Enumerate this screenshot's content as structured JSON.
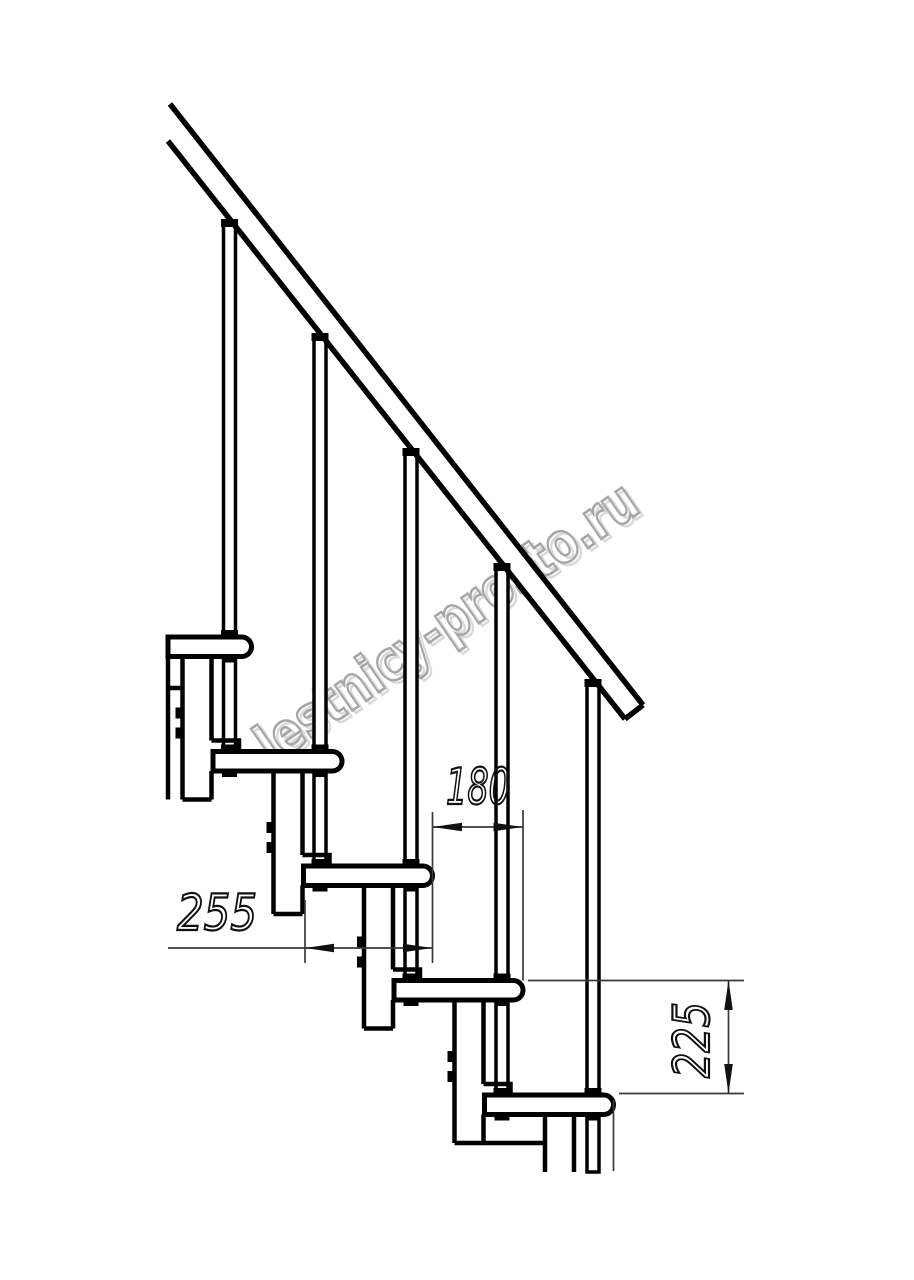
{
  "drawing": {
    "watermark": "lestnicy-prosto.ru",
    "steps_visible": 5,
    "balusters_visible": 5,
    "dimensions": {
      "tread_depth": {
        "value": "255",
        "orientation": "horizontal"
      },
      "nosing_offset": {
        "value": "180",
        "orientation": "horizontal"
      },
      "step_rise": {
        "value": "225",
        "orientation": "vertical"
      }
    },
    "colors": {
      "line": "#000000",
      "thin_line": "#3a3a3a",
      "watermark_outline": "#a6a6a6",
      "background": "#ffffff"
    }
  }
}
